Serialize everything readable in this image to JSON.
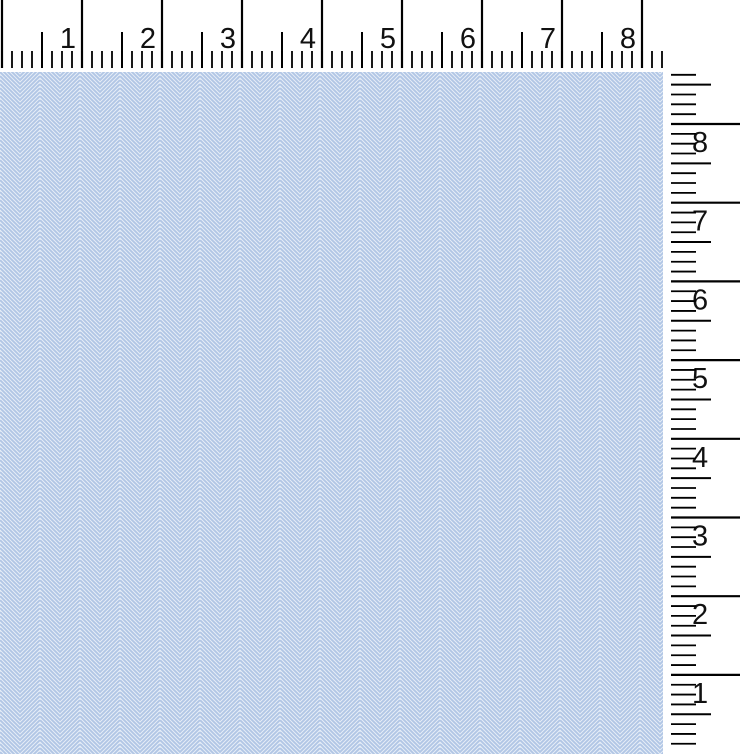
{
  "scene": {
    "width": 740,
    "height": 754,
    "background_color": "#ffffff"
  },
  "fabric": {
    "x": 0,
    "y": 72,
    "width": 663,
    "height": 682,
    "base_color": "#f9fbfe",
    "stripe_color": "#b1c6e5",
    "texture_color": "#e4ecf6",
    "chevron_width": 40,
    "stripe_period": 4,
    "stripe_width": 2.1,
    "texture_width": 0.9
  },
  "top_ruler": {
    "labels": [
      "1",
      "2",
      "3",
      "4",
      "5",
      "6",
      "7",
      "8"
    ],
    "origin_x": 2,
    "minor_step": 10,
    "minor_count": 66,
    "integer_every": 8,
    "half_every": 4,
    "tick_bottom": 68,
    "integer_top": 0,
    "half_top": 32,
    "minor_top": 51,
    "integer_stroke": 2.2,
    "half_stroke": 2,
    "minor_stroke": 1.8,
    "label_dx": -6,
    "label_baseline": 48,
    "font_size": 29,
    "tick_color": "#000000",
    "label_color": "#111111"
  },
  "right_ruler": {
    "labels": [
      "8",
      "7",
      "6",
      "5",
      "4",
      "3",
      "2",
      "1"
    ],
    "integer_origin_y": 124,
    "minor_step": 9.8375,
    "j_start": -5,
    "j_end": 63,
    "integer_every": 8,
    "half_mod": 4,
    "tick_x0": 671,
    "integer_x1": 740,
    "half_x1": 711,
    "minor_x1": 696,
    "integer_stroke": 2.2,
    "half_stroke": 2,
    "minor_stroke": 1.8,
    "label_x": 692,
    "label_dy": 28,
    "font_size": 29,
    "tick_color": "#000000",
    "label_color": "#111111"
  }
}
